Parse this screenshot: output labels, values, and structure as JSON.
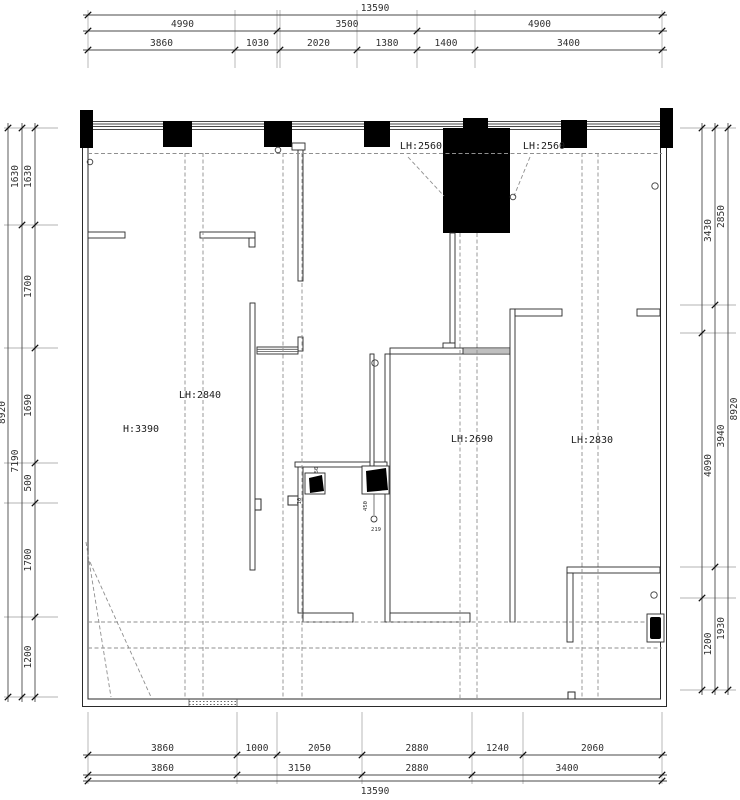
{
  "drawing_title": "floor-plan-ceiling-height-diagram",
  "colors": {
    "line": "#2a2a2a",
    "solid_fill": "#000000",
    "dashed_grid": "#8f8f8f",
    "dimension": "#4a4a4a",
    "background": "#ffffff"
  },
  "room_labels": [
    {
      "text": "LH:2560",
      "x": 421,
      "y": 149
    },
    {
      "text": "LH:2560",
      "x": 544,
      "y": 149
    },
    {
      "text": "LH:2840",
      "x": 200,
      "y": 398
    },
    {
      "text": "H:3390",
      "x": 141,
      "y": 432
    },
    {
      "text": "LH:2690",
      "x": 472,
      "y": 442
    },
    {
      "text": "LH:2830",
      "x": 592,
      "y": 443
    }
  ],
  "tiny_labels": [
    {
      "text": "450",
      "x": 367,
      "y": 506,
      "rot": -90
    },
    {
      "text": "219",
      "x": 376,
      "y": 531,
      "rot": 0
    },
    {
      "text": "50",
      "x": 318,
      "y": 470,
      "rot": -90
    },
    {
      "text": "10",
      "x": 301,
      "y": 501,
      "rot": -90
    }
  ],
  "dimensions": {
    "top_rows": [
      {
        "y": 15,
        "label_dy": -4,
        "ticks": [
          88,
          662
        ],
        "labels": [
          "13590"
        ]
      },
      {
        "y": 31,
        "label_dy": -4,
        "ticks": [
          88,
          277,
          417,
          662
        ],
        "labels": [
          "4990",
          "3500",
          "4900"
        ]
      },
      {
        "y": 50,
        "label_dy": -4,
        "ticks": [
          88,
          235,
          280,
          357,
          417,
          475,
          662
        ],
        "labels": [
          "3860",
          "1030",
          "2020",
          "1380",
          "1400",
          "3400"
        ]
      }
    ],
    "bottom_rows": [
      {
        "y": 755,
        "label_dy": -4,
        "ticks": [
          88,
          237,
          277,
          362,
          472,
          523,
          662
        ],
        "labels": [
          "3860",
          "1000",
          "2050",
          "2880",
          "1240",
          "2060"
        ]
      },
      {
        "y": 775,
        "label_dy": -4,
        "ticks": [
          88,
          237,
          362,
          472,
          662
        ],
        "labels": [
          "3860",
          "3150",
          "2880",
          "3400"
        ]
      },
      {
        "y": 781,
        "label_dy": 13,
        "ticks": [
          88,
          662
        ],
        "labels": [
          "13590"
        ]
      }
    ],
    "left_cols": [
      {
        "x": 8,
        "label_dx": -3,
        "ticks": [
          128,
          697
        ],
        "labels": [
          "8920"
        ]
      },
      {
        "x": 22,
        "label_dx": -4,
        "ticks": [
          128,
          225,
          697
        ],
        "labels": [
          "1630",
          "7190"
        ]
      },
      {
        "x": 35,
        "label_dx": -4,
        "ticks": [
          128,
          225,
          348,
          463,
          503,
          617,
          697
        ],
        "labels": [
          "1630",
          "1700",
          "1690",
          "500",
          "1700",
          "1200"
        ]
      }
    ],
    "right_cols": [
      {
        "x": 702,
        "label_dx": 9,
        "ticks": [
          128,
          333,
          598,
          690
        ],
        "labels": [
          "3430",
          "4090",
          "1200"
        ]
      },
      {
        "x": 715,
        "label_dx": 9,
        "ticks": [
          128,
          305,
          567,
          690
        ],
        "labels": [
          "2850",
          "3940",
          "1930"
        ]
      },
      {
        "x": 728,
        "label_dx": 9,
        "ticks": [
          128,
          690
        ],
        "labels": [
          "8920"
        ]
      }
    ],
    "extension_ranges": {
      "top": {
        "from": 10,
        "to": 68
      },
      "bottom": {
        "from": 712,
        "to": 784
      },
      "left": {
        "from": 4,
        "to": 58
      },
      "right": {
        "from": 680,
        "to": 736
      }
    }
  }
}
